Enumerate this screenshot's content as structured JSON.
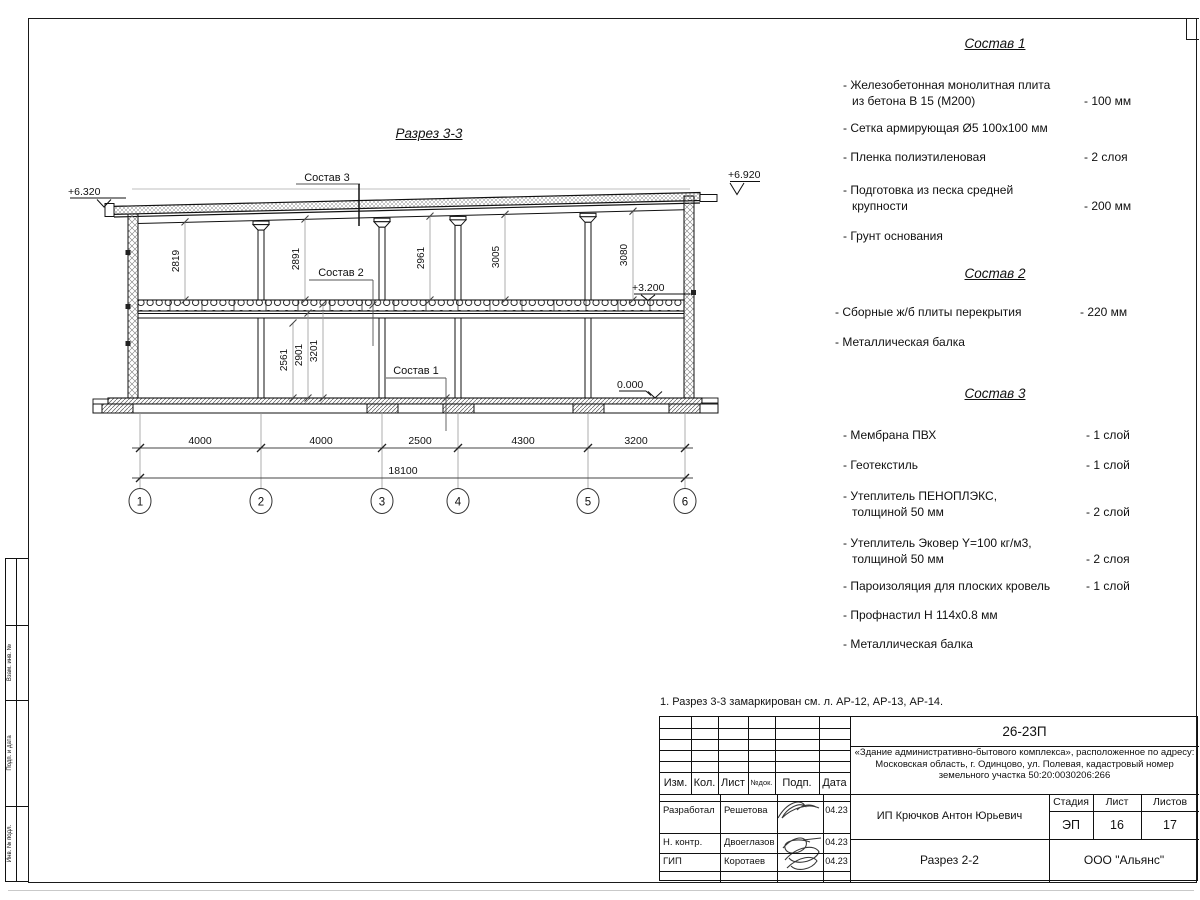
{
  "drawing": {
    "title": "Разрез 3-3",
    "elevations": {
      "eave_left": "+6.320",
      "eave_right": "+6.920",
      "floor2": "+3.200",
      "ground": "0.000"
    },
    "leaders": {
      "sostav1": "Состав 1",
      "sostav2": "Состав 2",
      "sostav3": "Состав 3"
    },
    "dims_upper": [
      "2819",
      "2891",
      "2961",
      "3005",
      "3080"
    ],
    "dims_lower": [
      "2561",
      "2901",
      "3201"
    ],
    "dims_bottom": [
      "4000",
      "4000",
      "2500",
      "4300",
      "3200"
    ],
    "dim_total": "18100",
    "axes": [
      "1",
      "2",
      "3",
      "4",
      "5",
      "6"
    ]
  },
  "panels": [
    {
      "title": "Состав 1",
      "items": [
        {
          "line1": "- Железобетонная  монолитная плита",
          "line2": "из бетона В 15 (М200)",
          "value": "- 100 мм"
        },
        {
          "line1": "- Сетка армирующая Ø5 100х100 мм"
        },
        {
          "line1": "- Пленка полиэтиленовая",
          "value": "- 2 слоя"
        },
        {
          "line1": "- Подготовка из песка средней",
          "line2": "крупности",
          "value": "- 200 мм"
        },
        {
          "line1": "- Грунт основания"
        }
      ]
    },
    {
      "title": "Состав 2",
      "items": [
        {
          "line1": "- Сборные ж/б плиты перекрытия",
          "value": "- 220 мм"
        },
        {
          "line1": "- Металлическая балка"
        }
      ]
    },
    {
      "title": "Состав 3",
      "items": [
        {
          "line1": "- Мембрана ПВХ",
          "value": "- 1 слой"
        },
        {
          "line1": "- Геотекстиль",
          "value": "- 1 слой"
        },
        {
          "line1": "- Утеплитель ПЕНОПЛЭКС,",
          "line2": "толщиной 50 мм",
          "value": "- 2 слой"
        },
        {
          "line1": "- Утеплитель Эковер Y=100 кг/м3,",
          "line2": "толщиной 50 мм",
          "value": "- 2 слоя"
        },
        {
          "line1": "- Пароизоляция для плоских кровель",
          "value": "- 1 слой"
        },
        {
          "line1": "- Профнастил Н 114х0.8 мм"
        },
        {
          "line1": "- Металлическая балка"
        }
      ]
    }
  ],
  "note": "1. Разрез 3-3 замаркирован см. л. АР-12, АР-13, АР-14.",
  "titleblock": {
    "code": "26-23П",
    "project": "«Здание административно-бытового комплекса», расположенное по адресу: Московская область, г. Одинцово, ул. Полевая, кадастровый номер земельного участка 50:20:0030206:266",
    "col_izm": "Изм.",
    "col_kol": "Кол.",
    "col_list": "Лист",
    "col_ndok": "№док.",
    "col_podp": "Подп.",
    "col_data": "Дата",
    "row1_role": "Разработал",
    "row1_name": "Решетова",
    "row1_date": "04.23",
    "row2_role": "Н. контр.",
    "row2_name": "Двоеглазов",
    "row2_date": "04.23",
    "row3_role": "ГИП",
    "row3_name": "Коротаев",
    "row3_date": "04.23",
    "client": "ИП Крючков Антон Юрьевич",
    "stage_label": "Стадия",
    "sheet_label": "Лист",
    "sheets_label": "Листов",
    "stage": "ЭП",
    "sheet": "16",
    "sheets": "17",
    "doc_name": "Разрез 2-2",
    "org": "ООО \"Альянс\""
  },
  "frame_strip": {
    "cell1": "Взам. инв. №",
    "cell2": "Подп. и дата",
    "cell3": "Инв. № подл."
  }
}
